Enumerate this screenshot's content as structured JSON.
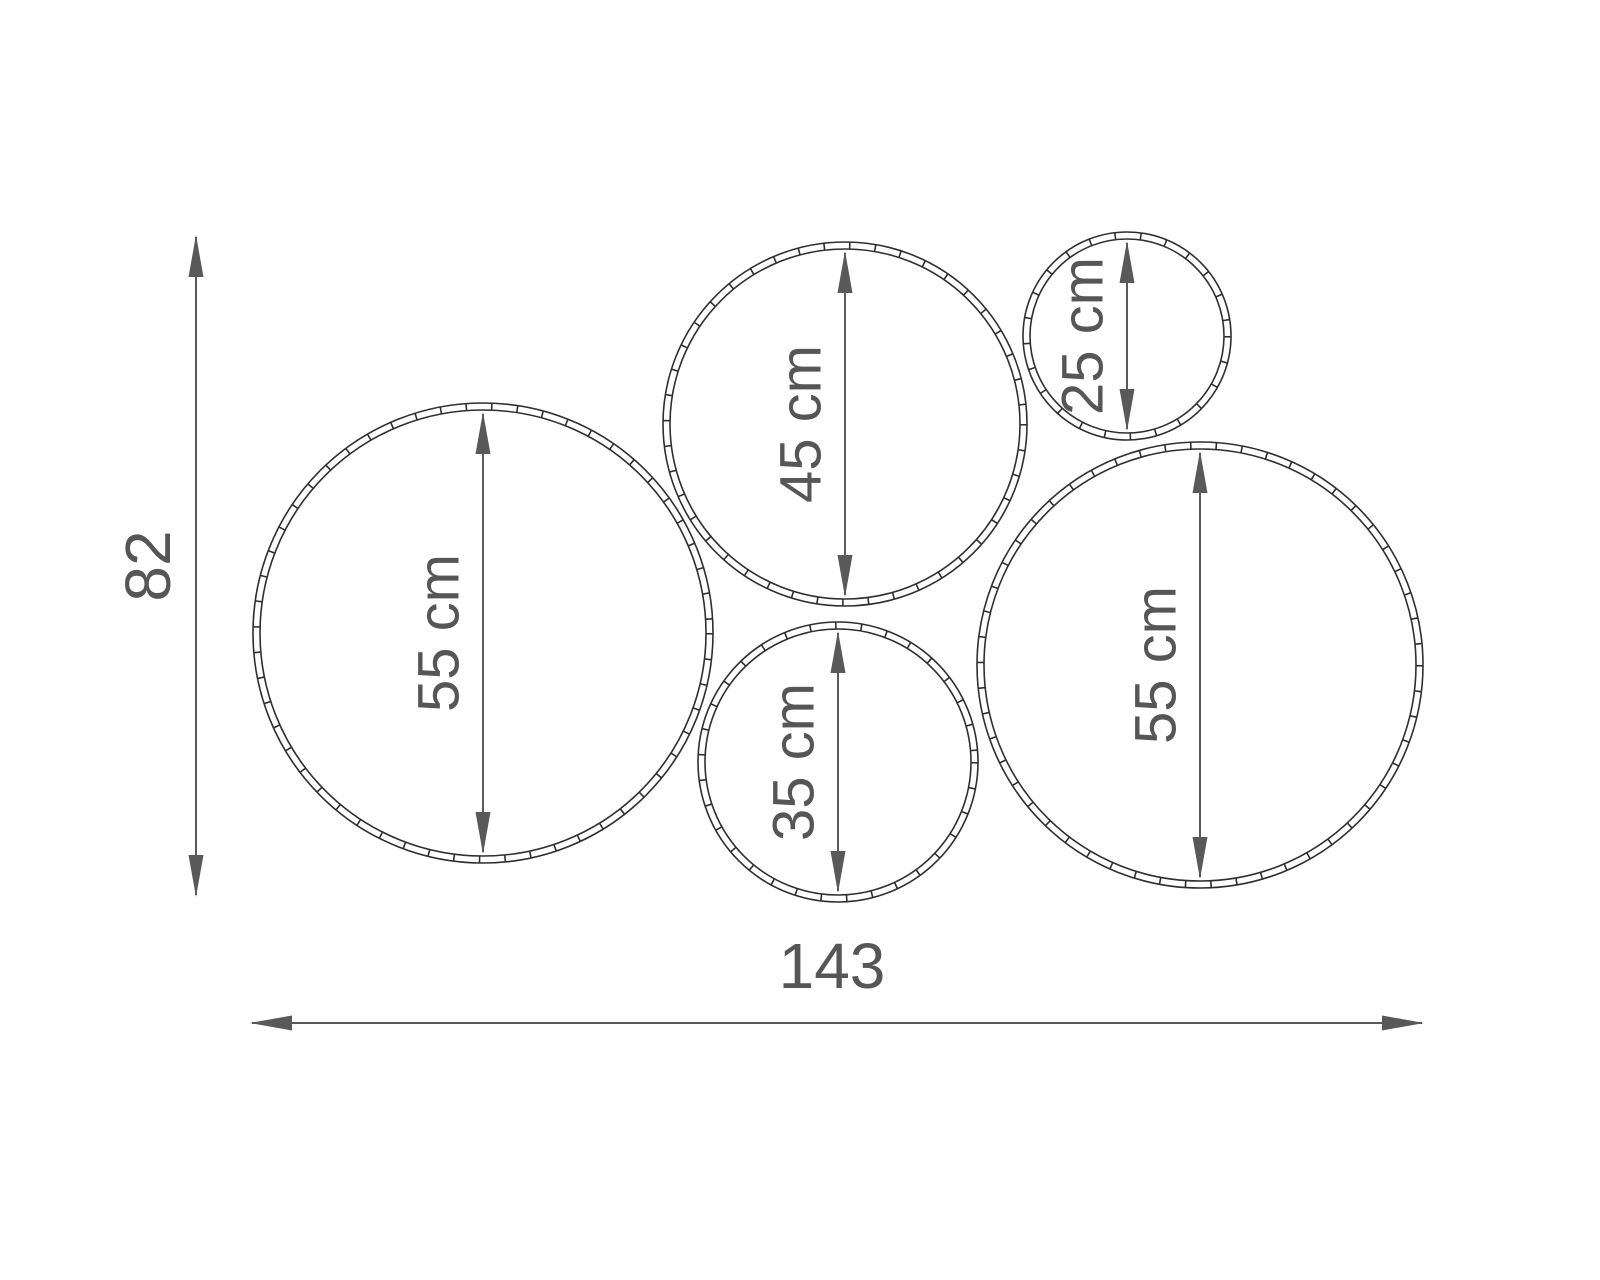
{
  "diagram": {
    "kind": "dimension-drawing",
    "description": "Five wall hoop rings with diameter dimensions",
    "unit": "cm",
    "colors": {
      "background": "#ffffff",
      "ring": "#2f2f2f",
      "dimension": "#595959",
      "label": "#565656"
    },
    "circles": [
      {
        "id": "circle-55-left",
        "label": "55 cm",
        "value": 55,
        "cx": 483,
        "cy": 633,
        "r": 230
      },
      {
        "id": "circle-45-top",
        "label": "45 cm",
        "value": 45,
        "cx": 845,
        "cy": 424,
        "r": 182
      },
      {
        "id": "circle-25-small",
        "label": "25 cm",
        "value": 25,
        "cx": 1127,
        "cy": 336,
        "r": 104
      },
      {
        "id": "circle-35-bottom",
        "label": "35 cm",
        "value": 35,
        "cx": 838,
        "cy": 762,
        "r": 140
      },
      {
        "id": "circle-55-right",
        "label": "55 cm",
        "value": 55,
        "cx": 1200,
        "cy": 665,
        "r": 223
      }
    ],
    "overall_height": {
      "label": "82",
      "value": 82,
      "line_x": 196,
      "y_top": 235,
      "y_bottom": 897,
      "label_x": 148,
      "label_y": 566
    },
    "overall_width": {
      "label": "143",
      "value": 143,
      "line_y": 1023,
      "x_left": 250,
      "x_right": 1424,
      "label_x": 832,
      "label_y": 966
    },
    "style": {
      "ring_line_width": 1.6,
      "ring_gap": 7,
      "tick_dash": "1.6 24",
      "dim_line_width": 2,
      "arrow_length": 42,
      "arrow_half_width": 7.5,
      "circle_label_font_size": 58,
      "overall_label_font_size": 64,
      "label_offset_from_arrow": -44,
      "arrow_inset": 9
    }
  }
}
